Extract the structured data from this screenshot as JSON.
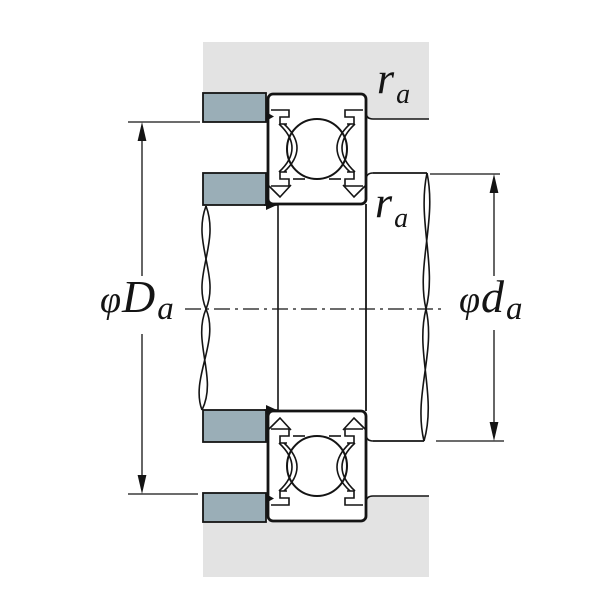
{
  "diagram": {
    "labels": {
      "fillet_housing": {
        "symbol": "r",
        "sub": "a"
      },
      "fillet_shaft": {
        "symbol": "r",
        "sub": "a"
      },
      "housing_abutment_diameter": {
        "phi": "φ",
        "symbol": "D",
        "sub": "a"
      },
      "shaft_abutment_diameter": {
        "phi": "φ",
        "symbol": "d",
        "sub": "a"
      }
    },
    "colors": {
      "housing": "#e3e3e3",
      "abutment_parts": "#9aaeb7",
      "lines": "#141414",
      "background": "#ffffff"
    }
  }
}
